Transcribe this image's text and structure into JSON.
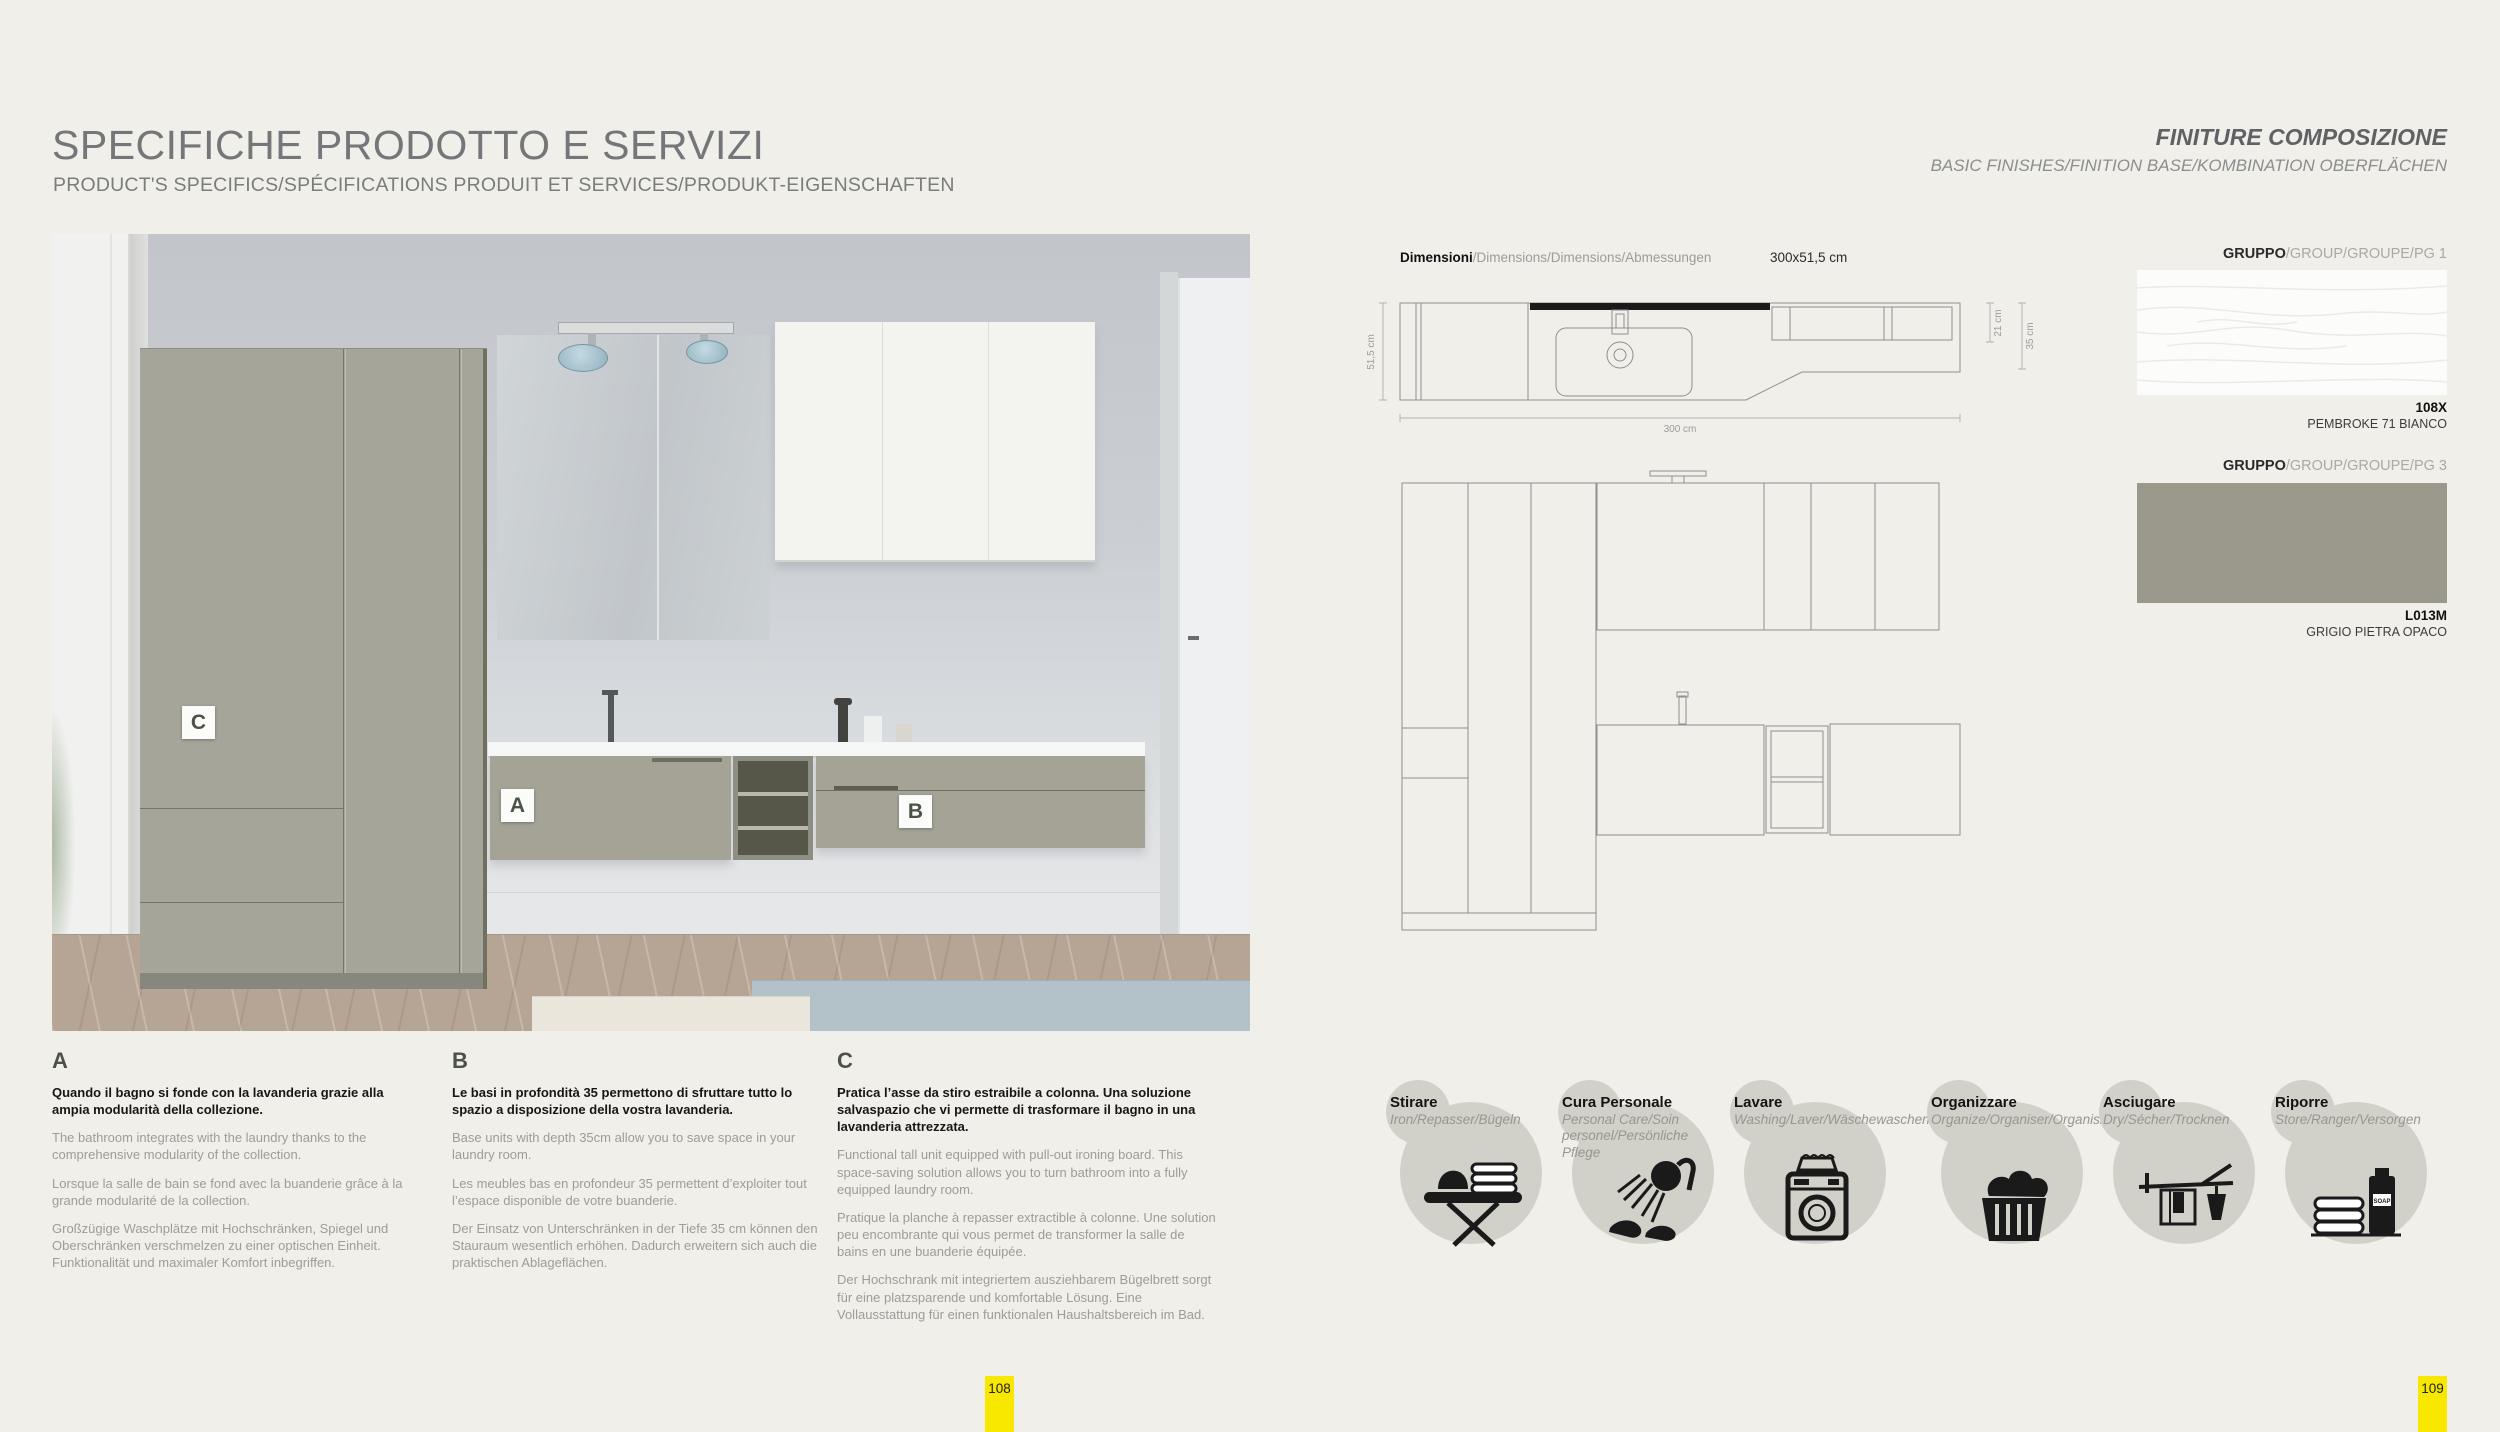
{
  "left_page": {
    "title": "SPECIFICHE PRODOTTO E SERVIZI",
    "subtitle": "PRODUCT'S SPECIFICS/SPÉCIFICATIONS PRODUIT ET SERVICES/PRODUKT-EIGENSCHAFTEN",
    "page_number": "108",
    "photo_markers": {
      "a": "A",
      "b": "B",
      "c": "C"
    },
    "sections": [
      {
        "letter": "A",
        "lead": "Quando il bagno si fonde con la lavanderia grazie alla ampia modularità della collezione.",
        "paragraphs": [
          "The bathroom integrates with the laundry thanks to the comprehensive modularity of the collection.",
          "Lorsque la salle de bain se fond avec la buanderie grâce à la grande modularité de la collection.",
          "Großzügige Waschplätze mit Hochschränken, Spiegel und Oberschränken verschmelzen zu einer optischen Einheit. Funktionalität und maximaler Komfort inbegriffen."
        ]
      },
      {
        "letter": "B",
        "lead": "Le basi in profondità 35 permettono di sfruttare tutto lo spazio a disposizione della vostra lavanderia.",
        "paragraphs": [
          "Base units with depth 35cm allow you to save space in your laundry room.",
          "Les meubles bas en profondeur 35 permettent d’exploiter tout l’espace disponible de votre buanderie.",
          "Der Einsatz von Unterschränken in der Tiefe 35 cm können den Stauraum wesentlich erhöhen. Dadurch erweitern sich auch die praktischen Ablageflächen."
        ]
      },
      {
        "letter": "C",
        "lead": "Pratica l’asse da stiro estraibile a colonna. Una soluzione salvaspazio che vi permette di trasformare il bagno in una lavanderia attrezzata.",
        "paragraphs": [
          "Functional tall unit equipped with pull-out ironing board. This space-saving solution allows you to turn bathroom into a fully equipped laundry room.",
          "Pratique la planche à repasser extractible à colonne. Une solution peu encombrante qui vous permet de transformer la salle de bains en une buanderie équipée.",
          "Der Hochschrank mit integriertem ausziehbarem Bügelbrett sorgt für eine platzsparende und komfortable Lösung. Eine Vollausstattung für einen funktionalen Haushaltsbereich im Bad."
        ]
      }
    ]
  },
  "right_page": {
    "title": "FINITURE COMPOSIZIONE",
    "subtitle": "BASIC FINISHES/FINITION BASE/KOMBINATION OBERFLÄCHEN",
    "page_number": "109",
    "dimensions": {
      "label_bold": "Dimensioni",
      "label_rest": "/Dimensions/Dimensions/Abmessungen",
      "value": "300x51,5 cm"
    },
    "drawing_dims": {
      "width": "300 cm",
      "depth": "51,5 cm",
      "d21": "21 cm",
      "d35": "35 cm"
    },
    "finishes": [
      {
        "group_bold": "GRUPPO",
        "group_rest": "/GROUP/GROUPE/PG 1",
        "code": "108X",
        "name": "PEMBROKE 71 BIANCO",
        "color": "#fcfcfa"
      },
      {
        "group_bold": "GRUPPO",
        "group_rest": "/GROUP/GROUPE/PG 3",
        "code": "L013M",
        "name": "GRIGIO PIETRA OPACO",
        "color": "#9b998b"
      }
    ],
    "functions": [
      {
        "title": "Stirare",
        "subtitle": "Iron/Repasser/Bügeln"
      },
      {
        "title": "Cura Personale",
        "subtitle": "Personal Care/Soin personel/Persönliche Pflege"
      },
      {
        "title": "Lavare",
        "subtitle": "Washing/Laver/Wäschewaschen"
      },
      {
        "title": "Organizzare",
        "subtitle": "Organize/Organiser/Organisieren"
      },
      {
        "title": "Asciugare",
        "subtitle": "Dry/Sécher/Trocknen"
      },
      {
        "title": "Riporre",
        "subtitle": "Store/Ranger/Versorgen"
      }
    ]
  }
}
